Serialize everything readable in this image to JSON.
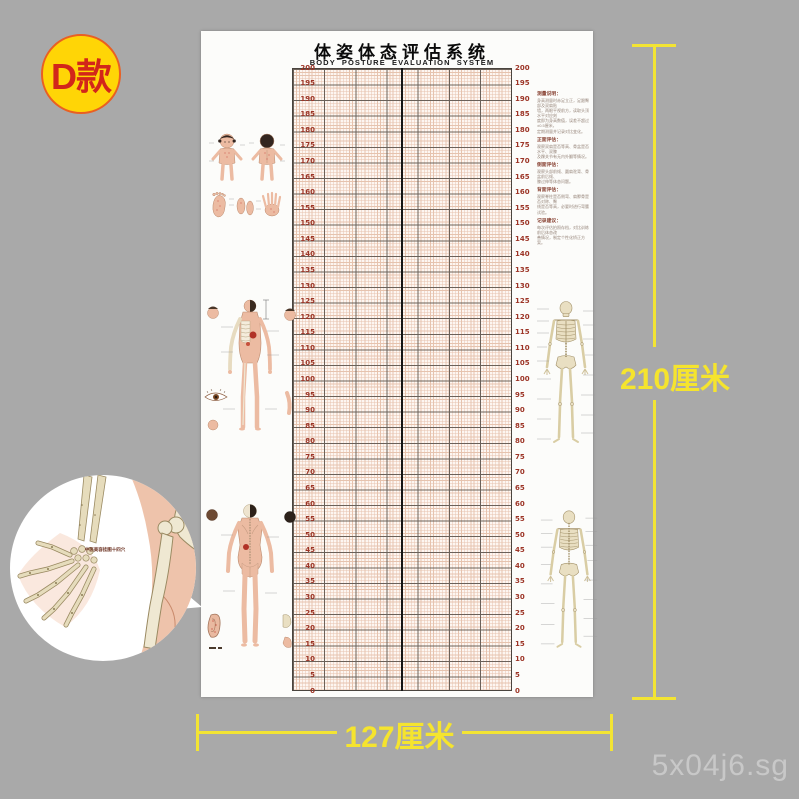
{
  "badge": {
    "label": "D款"
  },
  "poster": {
    "title": "体姿体态评估系统",
    "subtitle": "BODY POSTURE EVALUATION SYSTEM",
    "scale": {
      "max": 200,
      "min": 0,
      "step": 5,
      "unit": "cm",
      "label_color": "#9c3426"
    },
    "annotations": {
      "paragraphs": [
        {
          "heading": "测量说明：",
          "lines": [
            "身高测量时赤足立正，足跟臀部及双肩贴",
            "墙，两眼平视前方，读取头顶水平对应刻",
            "度即为身高数值，误差不超过±0.5厘米，",
            "定期测量并记录对比变化。"
          ]
        },
        {
          "heading": "正面评估：",
          "lines": [
            "观察双肩是否等高、骨盆是否水平、双膝",
            "及踝关节有无内外翻等情况。"
          ]
        },
        {
          "heading": "侧面评估：",
          "lines": [
            "观察头部前倾、圆肩驼背、骨盆前后倾、",
            "膝过伸等体态问题。"
          ]
        },
        {
          "heading": "背面评估：",
          "lines": [
            "观察脊柱是否侧弯、肩胛骨是否对称、臀",
            "线是否等高，必要时进行弯腰试验。"
          ]
        },
        {
          "heading": "记录建议：",
          "lines": [
            "每次评估拍照存档，对比训练前后体态改",
            "善情况，制定个性化矫正方案。"
          ]
        }
      ]
    },
    "inset_label": "中医美容挂图十四穴"
  },
  "dimensions": {
    "height_label": "210厘米",
    "width_label": "127厘米",
    "color": "#f3e433"
  },
  "watermark": "5x04j6.sg",
  "colors": {
    "background": "#a9a9a9",
    "badge_fill": "#ffd506",
    "badge_text": "#d2261a",
    "grid_fine_line": "#e6c3ae",
    "grid_major_line": "#6b6159",
    "scale_numbers": "#9c3426",
    "skin": "#ecbba2",
    "bone": "#e9dfc2"
  }
}
